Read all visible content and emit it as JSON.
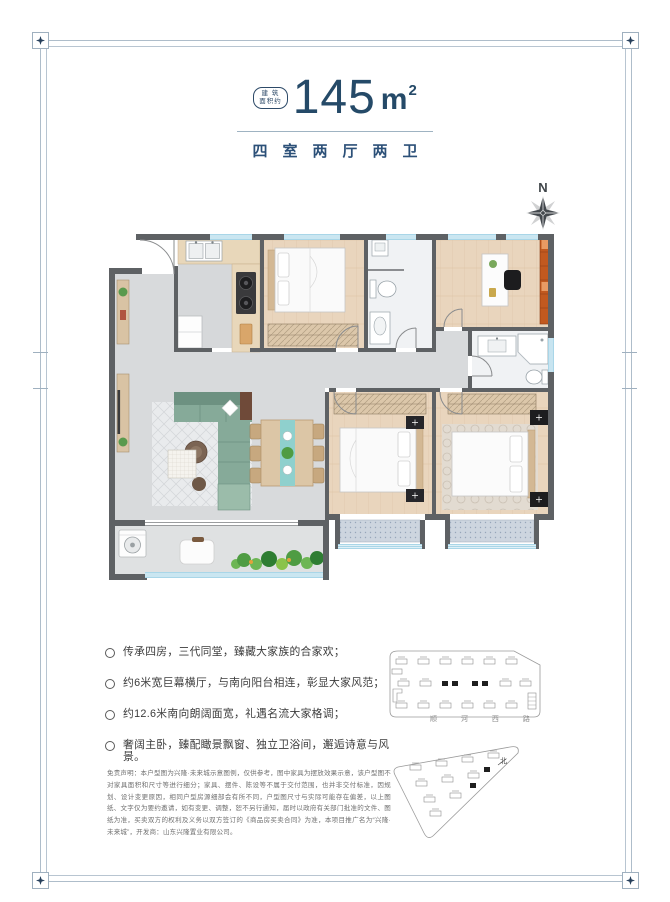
{
  "header": {
    "badge": {
      "line1": "建 筑",
      "line2": "面积约"
    },
    "area": {
      "value": "145",
      "unit": "m",
      "sup": "2"
    },
    "layout_title": "四室两厅两卫"
  },
  "compass": {
    "north_label": "N"
  },
  "features": {
    "items": [
      "传承四房，三代同堂，臻藏大家族的合家欢；",
      "约6米宽巨幕横厅，与南向阳台相连，彰显大家风范；",
      "约12.6米南向朗阔面宽，礼遇名流大家格调；",
      "奢阔主卧，臻配瞰景飘窗、独立卫浴间，邂逅诗意与风景。"
    ]
  },
  "disclaimer": "免责声明：本户型图为兴隆·未来城示意图例，仅供参考，图中家具为摆放效果示意，该户型图不对家具面积和尺寸等进行细分；家具、摆件、陈设等不属于交付范围，也并非交付标准，因规划、设计变更原因，相同户型房源细部会有所不同，户型图尺寸与实际可能存在偏差，以上图纸、文字仅为要约邀请，如有变更、调整，恕不另行通知，届时以政府有关部门批准的文件、图纸为准，买卖双方的权利及义务以双方签订的《商品房买卖合同》为准，本项目推广名为“兴隆·未来城”，开发商：山东兴隆置业有限公司。",
  "siteplan": {
    "road_label": "顺 河 西 路",
    "north_label": "北"
  },
  "colors": {
    "accent_navy": "#254a68",
    "frame_line": "#aebdca",
    "wall_gray": "#5e6164",
    "floor_gray": "#d8dadc",
    "floor_wood": "#e9d5bd",
    "window_blue": "#a9d6e8",
    "sofa_teal": "#86aa99",
    "shelf_orange": "#c2591f"
  }
}
